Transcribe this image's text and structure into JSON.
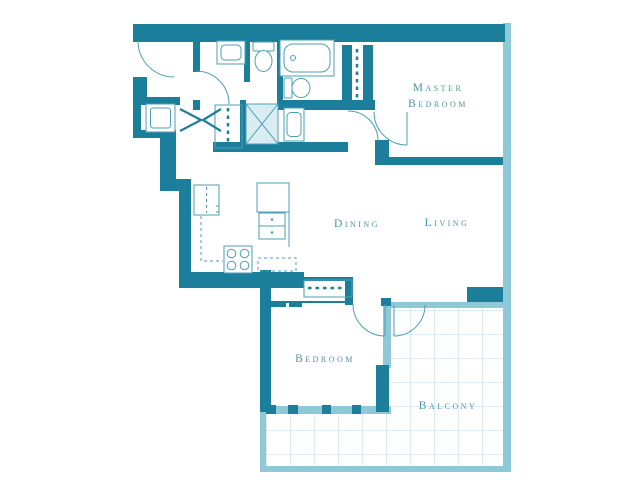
{
  "rooms": {
    "master_bedroom": {
      "line1": "Master",
      "line2": "Bedroom"
    },
    "dining": {
      "label": "Dining"
    },
    "living": {
      "label": "Living"
    },
    "bedroom": {
      "label": "Bedroom"
    },
    "balcony": {
      "label": "Balcony"
    }
  },
  "colors": {
    "wall": "#1b7f9b",
    "window": "#8fc8d6",
    "fixture": "#4d9fb4",
    "grid": "#b8dae4",
    "shower": "#d8ecf2",
    "text": "#4e94a4"
  }
}
